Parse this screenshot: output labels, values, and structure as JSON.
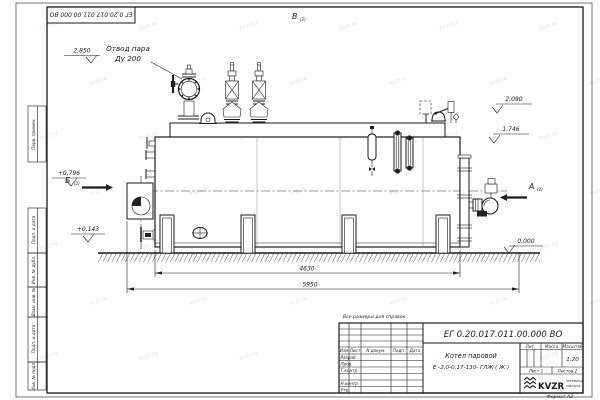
{
  "sheet": {
    "doc_number_rotated": "ЕГ 0.20.017.011.00.000  ВО",
    "reference_note": "Все размеры для справок",
    "format_label": "Формат А3",
    "watermark": "kvzr.ru"
  },
  "side_stamps": {
    "top": "Перв. примен.",
    "cells": [
      "Подп. и дата",
      "Инв. № дубл.",
      "Взам. инв. №",
      "Подп. и дата",
      "Инв. № подл."
    ]
  },
  "annotations": {
    "steam_outlet": {
      "line1": "Отвод пара",
      "line2": "Ду 200"
    },
    "levels": {
      "l2850": "2,850",
      "l2090": "2,090",
      "l1746": "1,746",
      "l0796": "+0,796",
      "l0143": "+0,143",
      "l0000": "0,000"
    },
    "views": {
      "a": "А",
      "b": "Б",
      "v": "В",
      "sheet_ref": "(2)"
    },
    "dims": {
      "inner": "4630",
      "overall": "5950"
    }
  },
  "title_block": {
    "doc_number": "ЕГ 0.20.017.011.00.000   ВО",
    "product_line1": "Котел паровой",
    "product_line2": "Е -2,0-0,17-130- ГЛЖ ( Ж )",
    "col_headers": [
      "Изм",
      "Лист",
      "N докум.",
      "Подп.",
      "Дата"
    ],
    "row_labels": [
      "Разраб.",
      "Пров.",
      "Т.контр.",
      "Н.контр.",
      "Утв."
    ],
    "lit_header": "Лит.",
    "mass_header": "Масса",
    "scale_header": "Масштаб",
    "scale_value": "1:20",
    "sheet_info": "Лист  1",
    "sheets_info": "Листов  2",
    "logo_text": "KVZR",
    "logo_sub1": "КОТЕЛЬНЫЙ",
    "logo_sub2": "ЗАВОД РФ"
  }
}
